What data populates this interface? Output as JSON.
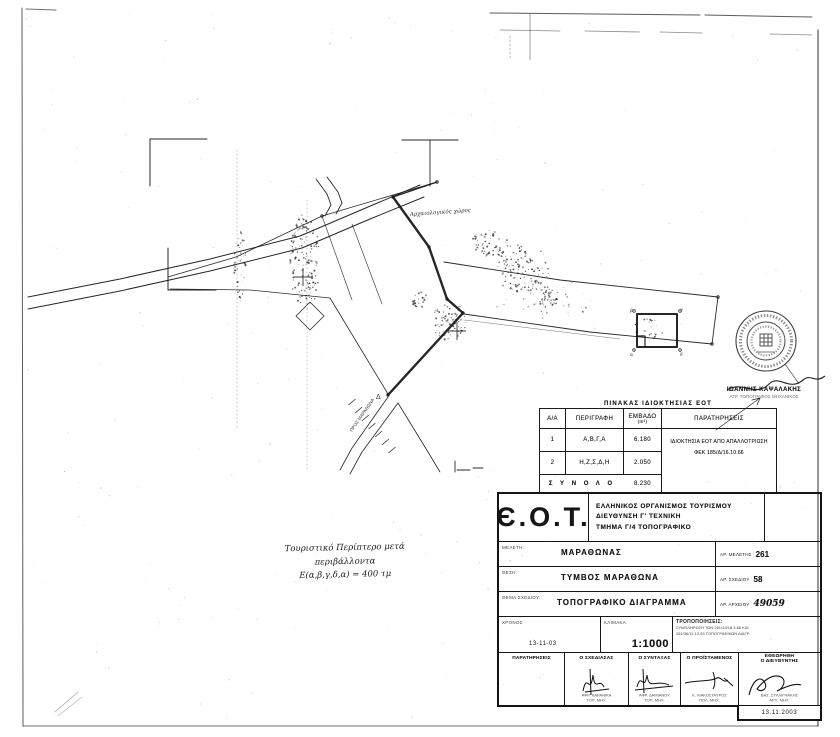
{
  "ownership_table": {
    "title": "ΠΙΝΑΚΑΣ ΙΔΙΟΚΤΗΣΙΑΣ ΕΟΤ",
    "col_aa": "Α/Α",
    "col_desc": "ΠΕΡΙΓΡΑΦΗ",
    "col_area": "ΕΜΒΑΔΟ",
    "col_area_unit": "(m²)",
    "col_remarks": "ΠΑΡΑΤΗΡΗΣΕΙΣ",
    "rows": [
      {
        "no": "1",
        "desc": "Α,Β,Γ,Α",
        "area": "6.180"
      },
      {
        "no": "2",
        "desc": "Η,Ζ,Σ,Δ,Η",
        "area": "2.050"
      }
    ],
    "remarks_line1": "ΙΔΙΟΚΤΗΣΙΑ ΕΟΤ ΑΠΟ ΑΠΑΛΛΟΤΡΙΩΣΗ",
    "remarks_line2": "ΦΕΚ 185/Δ/16.10.66",
    "total_label": "Σ Υ Ν Ο Λ Ο",
    "total_area": "8.230"
  },
  "title_block": {
    "logo": "Є.Ο.Τ.",
    "org_line1": "ΕΛΛΗΝΙΚΟΣ ΟΡΓΑΝΙΣΜΟΣ ΤΟΥΡΙΣΜΟΥ",
    "org_line2": "ΔΙΕΥΘΥΝΣΗ Γ' ΤΕΧΝΙΚΗ",
    "org_line3": "ΤΜΗΜΑ Γ/4 ΤΟΠΟΓΡΑΦΙΚΟ",
    "meleti_label": "ΜΕΛΕΤΗ:",
    "meleti": "ΜΑΡΑΘΩΝΑΣ",
    "ar_meletis_label": "ΑΡ. ΜΕΛΕΤΗΣ",
    "ar_meletis": "261",
    "thesi_label": "ΘΕΣΗ:",
    "thesi": "ΤΥΜΒΟΣ ΜΑΡΑΘΩΝΑ",
    "ar_sxediou_label": "ΑΡ. ΣΧΕΔΙΟΥ",
    "ar_sxediou": "58",
    "thema_label": "ΘΕΜΑ ΣΧΕΔΙΟΥ:",
    "thema": "ΤΟΠΟΓΡΑΦΙΚΟ ΔΙΑΓΡΑΜΜΑ",
    "ar_arxeiou_label": "ΑΡ. ΑΡΧΕΙΟΥ",
    "ar_arxeiou": "49059",
    "xronos_label": "ΧΡΟΝΟΣ",
    "xronos": "13-11-03",
    "klimaka_label": "ΚΛΙΜΑΚΑ",
    "klimaka": "1:1000",
    "trop_label": "ΤΡΟΠΟΠΟΙΗΣΕΙΣ:",
    "trop_line1": "ΣΥΜΠΛΗΡΩΣΗ ΤΩΝ 261/13/18.3.66 ΚΑΙ",
    "trop_line2": "261/36/11.12.03 ΤΟΠΟΓΡΑΦΙΚΩΝ ΔΙΑΓΡ.",
    "sig_paratiriseis": "ΠΑΡΑΤΗΡΗΣΕΙΣ",
    "sig_cols": [
      {
        "role": "Ο ΣΧΕΔΙΑΣΑΣ",
        "name": "ΑΦΡ. ΚΑΡΑΝΙΚΑ",
        "title": "ΤΟΠ. ΜΗΧ."
      },
      {
        "role": "Ο ΣΥΝΤΑΞΑΣ",
        "name": "ΑΦΡ. ΔΑΜΙΑΝΟΥ",
        "title": "ΤΟΠ. ΜΗΧ."
      },
      {
        "role": "Ο ΠΡΟΪΣΤΑΜΕΝΟΣ",
        "name": "Κ. ΛΙΑΚΟΣΤΑΥΡΟΣ",
        "title": "ΠΟΛ. ΜΗΧ."
      }
    ],
    "etheorithi": "ΕΘΕΩΡΗΘΗ",
    "dieythintis": "Ο ΔΙΕΥΘΥΝΤΗΣ",
    "dir_name": "ΒΑΣ. ΣΥΛΛΙΓΝΑΚΗΣ",
    "dir_title": "ΑΡΧ. ΜΗΧ.",
    "date": "13.11.2003"
  },
  "stamp": {
    "name": "ΙΩΑΝΝΗΣ ΚΑΨΑΛΑΚΗΣ",
    "title": "ΑΓΡ. ΤΟΠΟΓΡΑΦΟΣ ΜΗΧΑΝΙΚΟΣ"
  },
  "handnote": {
    "line1": "Τουριστικό Περίπτερο μετά περιβάλλοντα",
    "line2": "Ε(α,β,γ,δ,α) = 400 τμ"
  },
  "map": {
    "ink": "#151515",
    "labels": [
      {
        "t": "Αρχαιολογικός χώρος",
        "x": 410,
        "y": 216,
        "s": 5.5,
        "r": -4,
        "hand": true
      },
      {
        "t": "ΠΡΟΣ ΜΑΡΑΘΩΝΑ",
        "x": 352,
        "y": 432,
        "s": 4.5,
        "r": -55
      },
      {
        "t": "Δ",
        "x": 376,
        "y": 399,
        "s": 7
      },
      {
        "t": "β",
        "x": 630,
        "y": 312,
        "s": 4.5,
        "hand": true
      },
      {
        "t": "γ",
        "x": 680,
        "y": 311,
        "s": 4.5,
        "hand": true
      },
      {
        "t": "α",
        "x": 630,
        "y": 356,
        "s": 4.5,
        "hand": true
      },
      {
        "t": "δ",
        "x": 680,
        "y": 356,
        "s": 4.5,
        "hand": true
      }
    ],
    "lines": [
      {
        "p": [
          [
            28,
            297
          ],
          [
            120,
            279
          ],
          [
            210,
            259
          ],
          [
            300,
            236
          ],
          [
            368,
            207
          ],
          [
            420,
            185
          ]
        ],
        "w": 1
      },
      {
        "p": [
          [
            28,
            309
          ],
          [
            120,
            291
          ],
          [
            210,
            271
          ],
          [
            302,
            248
          ],
          [
            370,
            219
          ],
          [
            424,
            197
          ]
        ],
        "w": 1
      },
      {
        "p": [
          [
            316,
            179
          ],
          [
            327,
            194
          ],
          [
            331,
            205
          ],
          [
            325,
            216
          ]
        ],
        "w": 0.9
      },
      {
        "p": [
          [
            327,
            177
          ],
          [
            338,
            192
          ],
          [
            342,
            203
          ],
          [
            336,
            214
          ]
        ],
        "w": 0.9
      },
      {
        "p": [
          [
            437,
            182
          ],
          [
            322,
            216
          ],
          [
            236,
            257
          ],
          [
            168,
            277
          ]
        ],
        "w": 0.8
      },
      {
        "p": [
          [
            322,
            216
          ],
          [
            352,
            300
          ]
        ],
        "w": 0.7,
        "op": 0.8
      },
      {
        "p": [
          [
            352,
            224
          ],
          [
            382,
            304
          ]
        ],
        "w": 0.7,
        "op": 0.8
      },
      {
        "p": [
          [
            170,
            289
          ],
          [
            250,
            290
          ],
          [
            330,
            298
          ]
        ],
        "w": 0.7,
        "op": 0.9
      },
      {
        "p": [
          [
            330,
            298
          ],
          [
            388,
            394
          ]
        ],
        "w": 0.8
      },
      {
        "p": [
          [
            444,
            262
          ],
          [
            560,
            280
          ],
          [
            718,
            297
          ]
        ],
        "w": 0.9
      },
      {
        "p": [
          [
            464,
            314
          ],
          [
            590,
            332
          ],
          [
            712,
            344
          ]
        ],
        "w": 0.9
      },
      {
        "p": [
          [
            718,
            297
          ],
          [
            712,
            344
          ]
        ],
        "w": 0.9
      },
      {
        "p": [
          [
            464,
            320
          ],
          [
            620,
            339
          ]
        ],
        "w": 0.5,
        "op": 0.6
      },
      {
        "p": [
          [
            388,
            397
          ],
          [
            352,
            448
          ],
          [
            340,
            470
          ]
        ],
        "w": 0.8
      },
      {
        "p": [
          [
            398,
            403
          ],
          [
            362,
            452
          ],
          [
            350,
            474
          ]
        ],
        "w": 0.8
      },
      {
        "p": [
          [
            398,
            403
          ],
          [
            428,
            452
          ],
          [
            440,
            472
          ]
        ],
        "w": 0.8
      },
      {
        "p": [
          [
            393,
            197
          ],
          [
            429,
            247
          ],
          [
            447,
            299
          ],
          [
            463,
            313
          ],
          [
            388,
            395
          ]
        ],
        "w": 2.4
      },
      {
        "p": [
          [
            437,
            182
          ],
          [
            393,
            197
          ]
        ],
        "w": 1.2
      },
      {
        "p": [
          [
            430,
            140
          ],
          [
            430,
            186
          ]
        ],
        "w": 0.9
      },
      {
        "p": [
          [
            402,
            140
          ],
          [
            458,
            140
          ]
        ],
        "w": 1
      },
      {
        "p": [
          [
            150,
            186
          ],
          [
            150,
            139
          ],
          [
            207,
            139
          ]
        ],
        "w": 1
      },
      {
        "p": [
          [
            168,
            248
          ],
          [
            168,
            290
          ],
          [
            216,
            290
          ]
        ],
        "w": 1
      },
      {
        "p": [
          [
            637,
            314
          ],
          [
            677,
            314
          ],
          [
            677,
            347
          ],
          [
            637,
            347
          ],
          [
            637,
            314
          ]
        ],
        "w": 2
      },
      {
        "p": [
          [
            637,
            336
          ],
          [
            645,
            336
          ],
          [
            645,
            347
          ]
        ],
        "w": 1.2
      },
      {
        "p": [
          [
            310,
            302
          ],
          [
            324,
            316
          ],
          [
            310,
            330
          ],
          [
            296,
            316
          ],
          [
            310,
            302
          ]
        ],
        "w": 0.8
      },
      {
        "p": [
          [
            716,
            430
          ],
          [
            760,
            398
          ]
        ],
        "w": 0.7
      },
      {
        "p": [
          [
            760,
            398
          ],
          [
            752,
            400
          ]
        ],
        "w": 0.7
      },
      {
        "p": [
          [
            760,
            398
          ],
          [
            757,
            405
          ]
        ],
        "w": 0.7
      },
      {
        "p": [
          [
            455,
            461
          ],
          [
            455,
            472
          ]
        ],
        "w": 0.9
      },
      {
        "p": [
          [
            457,
            470
          ],
          [
            470,
            470
          ]
        ],
        "w": 0.9
      },
      {
        "p": [
          [
            473,
            468
          ],
          [
            483,
            468
          ]
        ],
        "w": 0.9
      },
      {
        "p": [
          [
            237,
            150
          ],
          [
            237,
            430
          ]
        ],
        "w": 0.8,
        "dash": "1,3",
        "op": 0.35
      },
      {
        "p": [
          [
            307,
            200
          ],
          [
            307,
            470
          ]
        ],
        "w": 0.8,
        "dash": "1,3",
        "op": 0.3
      },
      {
        "p": [
          [
            530,
            14
          ],
          [
            530,
            60
          ]
        ],
        "w": 0.8,
        "op": 0.5
      },
      {
        "p": [
          [
            510,
            36
          ],
          [
            510,
            58
          ]
        ],
        "w": 0.7,
        "dash": "2,2",
        "op": 0.4
      },
      {
        "p": [
          [
            821,
            498
          ],
          [
            821,
            566
          ]
        ],
        "w": 1,
        "dash": "1,2",
        "op": 0.5
      },
      {
        "p": [
          [
            55,
            712
          ],
          [
            78,
            692
          ]
        ],
        "w": 0.6,
        "op": 0.4
      },
      {
        "p": [
          [
            58,
            716
          ],
          [
            82,
            697
          ]
        ],
        "w": 0.6,
        "op": 0.35
      },
      {
        "p": [
          [
            26,
            9
          ],
          [
            56,
            10
          ]
        ],
        "w": 1,
        "op": 0.6
      },
      {
        "p": [
          [
            490,
            13
          ],
          [
            700,
            15
          ]
        ],
        "w": 1,
        "op": 0.7
      },
      {
        "p": [
          [
            705,
            15
          ],
          [
            812,
            17
          ]
        ],
        "w": 1,
        "op": 0.7
      },
      {
        "p": [
          [
            500,
            30
          ],
          [
            560,
            31
          ]
        ],
        "w": 0.8,
        "op": 0.5
      },
      {
        "p": [
          [
            585,
            31
          ],
          [
            640,
            32
          ]
        ],
        "w": 0.8,
        "op": 0.5
      },
      {
        "p": [
          [
            660,
            32
          ],
          [
            702,
            33
          ]
        ],
        "w": 0.8,
        "op": 0.5
      },
      {
        "p": [
          [
            770,
            34
          ],
          [
            812,
            35
          ]
        ],
        "w": 0.8,
        "op": 0.5
      },
      {
        "p": [
          [
            22,
            8
          ],
          [
            23,
            726
          ]
        ],
        "w": 1,
        "op": 0.7
      },
      {
        "p": [
          [
            818,
            30
          ],
          [
            818,
            726
          ]
        ],
        "w": 1.2,
        "op": 0.75
      },
      {
        "p": [
          [
            23,
            726
          ],
          [
            818,
            726
          ]
        ],
        "w": 1,
        "op": 0.6
      }
    ],
    "crosses": [
      [
        303,
        277
      ],
      [
        457,
        331
      ]
    ],
    "cross_size": 9,
    "pegs": [
      [
        393,
        197
      ],
      [
        429,
        247
      ],
      [
        447,
        299
      ],
      [
        463,
        313
      ],
      [
        388,
        395
      ],
      [
        437,
        182
      ],
      [
        322,
        216
      ],
      [
        718,
        297
      ],
      [
        712,
        344
      ],
      [
        634,
        311
      ],
      [
        680,
        311
      ],
      [
        680,
        350
      ],
      [
        634,
        350
      ]
    ],
    "hatch": {
      "from": [
        352,
        402
      ],
      "to": [
        392,
        450
      ],
      "n": 7,
      "len": 9
    },
    "clusters": [
      {
        "cx": 305,
        "cy": 262,
        "rx": 15,
        "ry": 48,
        "n": 150
      },
      {
        "cx": 240,
        "cy": 265,
        "rx": 6,
        "ry": 34,
        "n": 45
      },
      {
        "cx": 490,
        "cy": 243,
        "rx": 18,
        "ry": 14,
        "n": 55
      },
      {
        "cx": 523,
        "cy": 268,
        "rx": 26,
        "ry": 25,
        "n": 120
      },
      {
        "cx": 547,
        "cy": 297,
        "rx": 12,
        "ry": 10,
        "n": 35
      },
      {
        "cx": 449,
        "cy": 321,
        "rx": 17,
        "ry": 19,
        "n": 80
      },
      {
        "cx": 420,
        "cy": 300,
        "rx": 8,
        "ry": 8,
        "n": 25
      },
      {
        "cx": 648,
        "cy": 329,
        "rx": 16,
        "ry": 10,
        "n": 25
      },
      {
        "cx": 540,
        "cy": 300,
        "rx": 55,
        "ry": 22,
        "n": 45,
        "op": 0.5
      },
      {
        "cx": 420,
        "cy": 365,
        "rx": 396,
        "ry": 356,
        "n": 230,
        "uniform": true,
        "op": 0.3,
        "rmax": 0.7
      }
    ]
  }
}
